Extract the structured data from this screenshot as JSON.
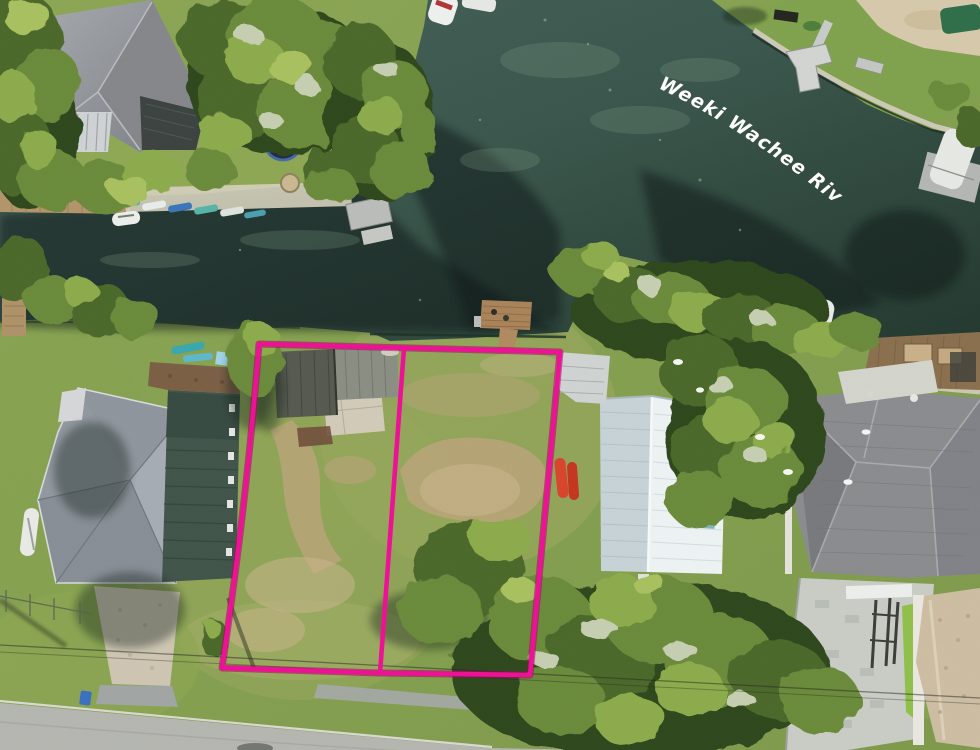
{
  "annotation": {
    "river_label": "Weeki Wachee River",
    "label_color": "#ffffff",
    "boundary_color": "#ee1095"
  },
  "scene": {
    "description_labels": {
      "water": "river and canal water",
      "lots": "two vacant waterfront lots outlined in pink",
      "road": "street along bottom edge"
    },
    "palette": {
      "water": "#33514a",
      "water_shadow": "#14231d",
      "grass": "#89a152",
      "tree": "#5d7c33",
      "road": "#b5b6b1",
      "dirt": "#bba47a",
      "dock_wood": "#a9835a"
    }
  }
}
